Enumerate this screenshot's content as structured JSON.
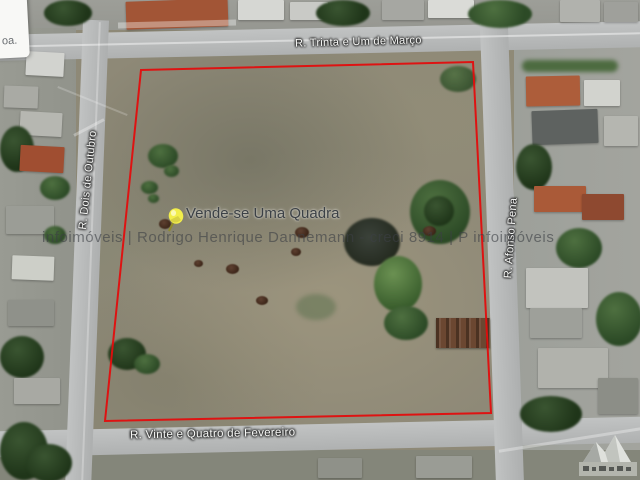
{
  "map": {
    "parcel_label": "Vende-se Uma Quadra",
    "streets": {
      "top": "R. Trinta e Um de Março",
      "left": "R. Dois de Outubro",
      "right": "R. Afonso Pena",
      "bottom": "R. Vinte e Quatro de Fevereiro"
    },
    "corner_label": "oa.",
    "boundary_points": "141,70 473,62 491,413 105,421",
    "boundary_color": "#e30d0d",
    "pin_color": "#f2ee4b"
  },
  "watermark": {
    "text": "infoimóveis  |  Rodrigo Henrique Dannemann - creci 8914 | P infoimóveis"
  },
  "icons": {
    "pin": "pushpin-icon",
    "logo": "infoimoveis-logo"
  }
}
